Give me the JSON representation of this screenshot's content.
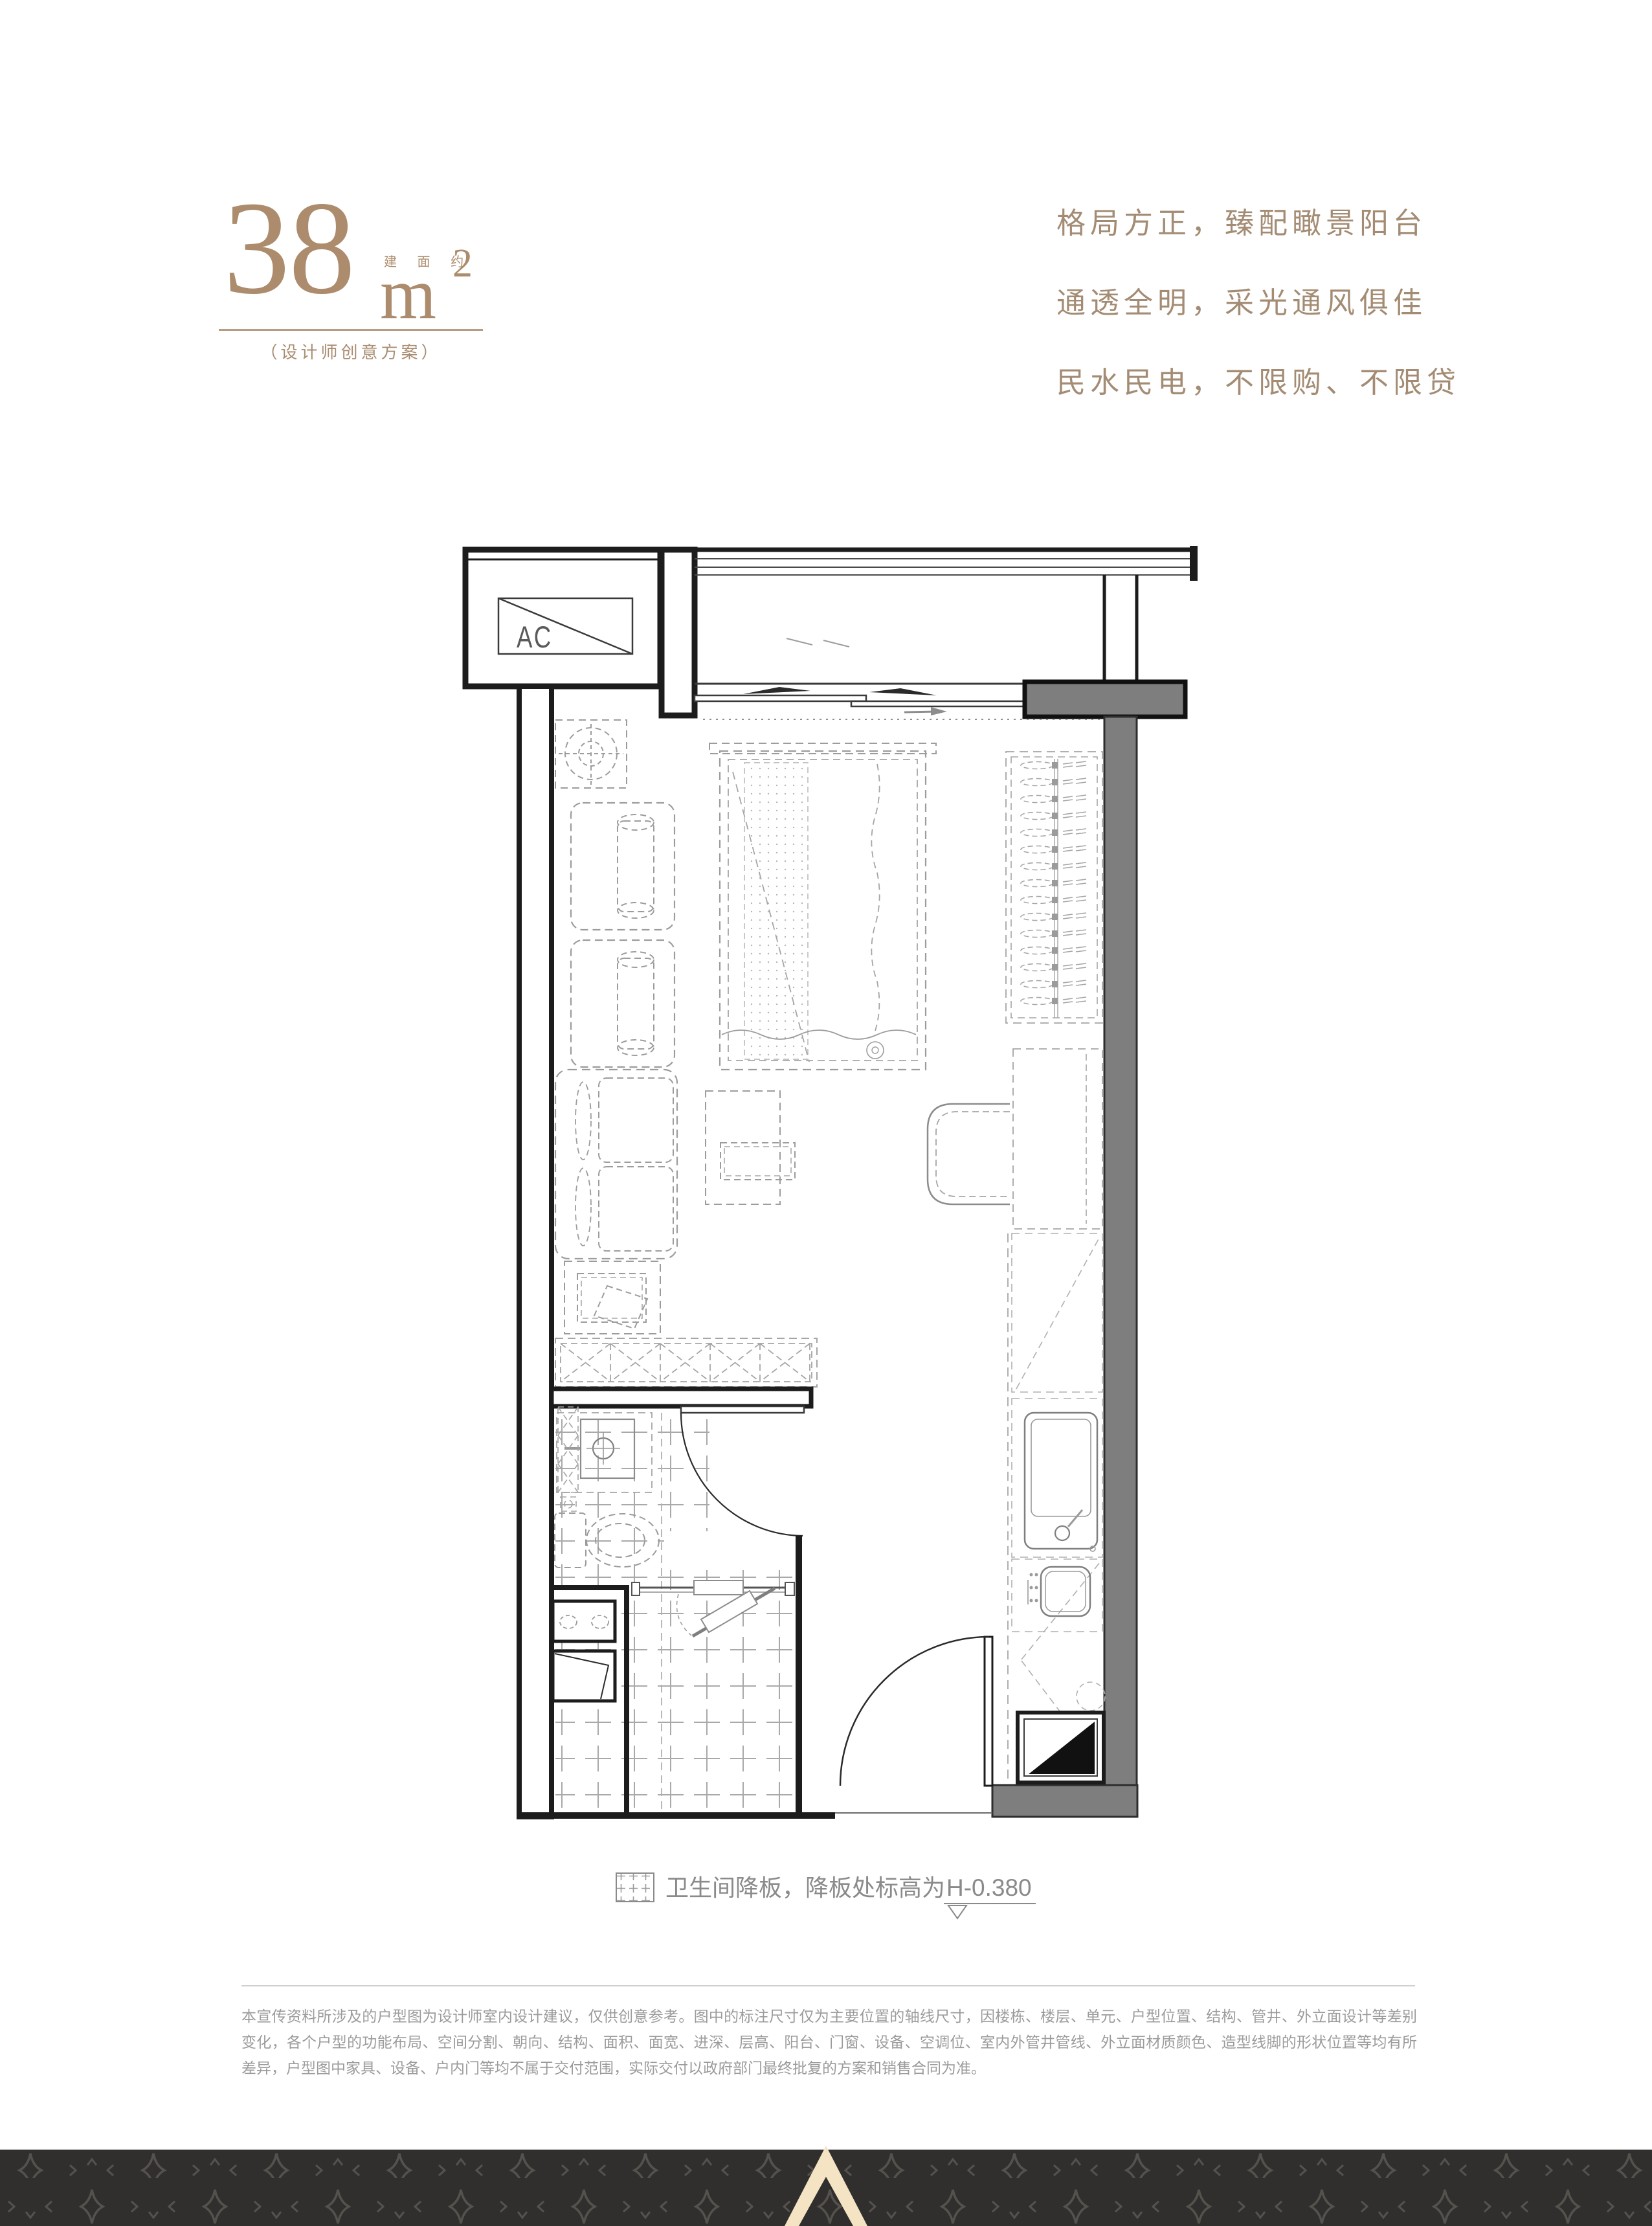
{
  "header": {
    "area_value": "38",
    "area_unit": "m",
    "area_exponent": "2",
    "area_prefix": "建 面 约",
    "subtitle": "（设计师创意方案）",
    "accent_color": "#ac8c6c"
  },
  "selling_points": {
    "lines": [
      "格局方正，臻配瞰景阳台",
      "通透全明，采光通风俱佳",
      "民水民电，不限购、不限贷"
    ],
    "text_color": "#a48c74"
  },
  "floorplan": {
    "ac_label": "AC",
    "wall_color": "#1c1c1c",
    "shear_wall_color": "#7e7e7e",
    "furniture_line_color": "#9c9c9c"
  },
  "legend": {
    "label": "卫生间降板，降板处标高为",
    "value": "H-0.380",
    "text_color": "#8a8a8a"
  },
  "disclaimer": {
    "text": "本宣传资料所涉及的户型图为设计师室内设计建议，仅供创意参考。图中的标注尺寸仅为主要位置的轴线尺寸，因楼栋、楼层、单元、户型位置、结构、管井、外立面设计等差别变化，各个户型的功能布局、空间分割、朝向、结构、面积、面宽、进深、层高、阳台、门窗、设备、空调位、室内外管井管线、外立面材质颜色、造型线脚的形状位置等均有所差异，户型图中家具、设备、户内门等均不属于交付范围，实际交付以政府部门最终批复的方案和销售合同为准。"
  },
  "footer": {
    "background_color": "#312f2d",
    "motif_color": "#55524e",
    "logo_color": "#f5e4c4"
  }
}
